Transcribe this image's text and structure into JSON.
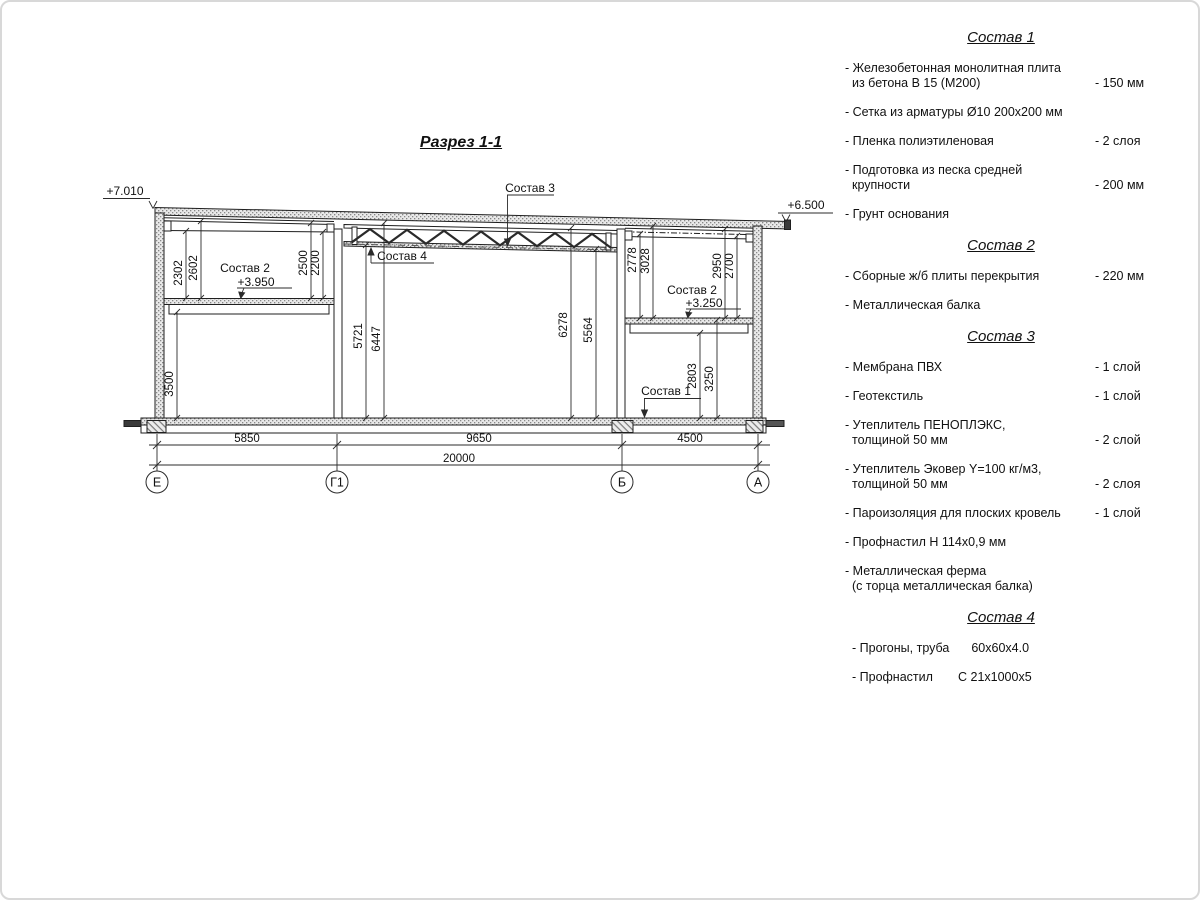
{
  "page": {
    "drawing_title": "Разрез 1-1"
  },
  "drawing": {
    "levels": {
      "roof_left": "+7.010",
      "roof_right": "+6.500",
      "floor_left": "+3.950",
      "floor_right": "+3.250"
    },
    "callouts": {
      "sostav1": "Состав 1",
      "sostav2_left": "Состав 2",
      "sostav2_right": "Состав 2",
      "sostav3": "Состав 3",
      "sostav4": "Состав 4"
    },
    "vdims": [
      "2302",
      "2602",
      "2500",
      "2200",
      "3500",
      "5721",
      "6447",
      "6278",
      "5564",
      "2778",
      "3028",
      "2950",
      "2700",
      "2803",
      "3250"
    ],
    "hdims": [
      "5850",
      "9650",
      "4500",
      "20000"
    ],
    "axes": [
      "Е",
      "Г1",
      "Б",
      "А"
    ]
  },
  "legend": {
    "sections": [
      {
        "title": "Состав 1",
        "items": [
          {
            "lines": [
              "- Железобетонная  монолитная плита",
              "из бетона В 15 (М200)"
            ],
            "value": "- 150 мм"
          },
          {
            "lines": [
              "- Сетка из арматуры Ø10 200х200 мм"
            ],
            "value": ""
          },
          {
            "lines": [
              "- Пленка полиэтиленовая"
            ],
            "value": "-  2 слоя"
          },
          {
            "lines": [
              "- Подготовка из песка средней",
              "крупности"
            ],
            "value": "- 200 мм"
          },
          {
            "lines": [
              "- Грунт основания"
            ],
            "value": ""
          }
        ]
      },
      {
        "title": "Состав 2",
        "items": [
          {
            "lines": [
              "- Сборные ж/б плиты перекрытия"
            ],
            "value": "- 220 мм"
          },
          {
            "lines": [
              "- Металлическая балка"
            ],
            "value": ""
          }
        ]
      },
      {
        "title": "Состав 3",
        "items": [
          {
            "lines": [
              "- Мембрана ПВХ"
            ],
            "value": "- 1 слой"
          },
          {
            "lines": [
              "- Геотекстиль"
            ],
            "value": "- 1 слой"
          },
          {
            "lines": [
              "- Утеплитель ПЕНОПЛЭКС,",
              "толщиной 50 мм"
            ],
            "value": "- 2 слой"
          },
          {
            "lines": [
              "- Утеплитель Эковер Y=100 кг/м3,",
              "толщиной 50 мм"
            ],
            "value": "- 2 слоя"
          },
          {
            "lines": [
              "- Пароизоляция для плоских кровель"
            ],
            "value": "- 1 слой"
          },
          {
            "lines": [
              "- Профнастил Н 114х0,9 мм"
            ],
            "value": ""
          },
          {
            "lines": [
              "- Металлическая ферма",
              "(с торца металлическая балка)"
            ],
            "value": ""
          }
        ]
      },
      {
        "title": "Состав 4",
        "items4": [
          {
            "name": "- Прогоны, труба",
            "spec": "60х60х4.0"
          },
          {
            "name": "- Профнастил",
            "spec": "С 21х1000х5"
          }
        ]
      }
    ]
  }
}
